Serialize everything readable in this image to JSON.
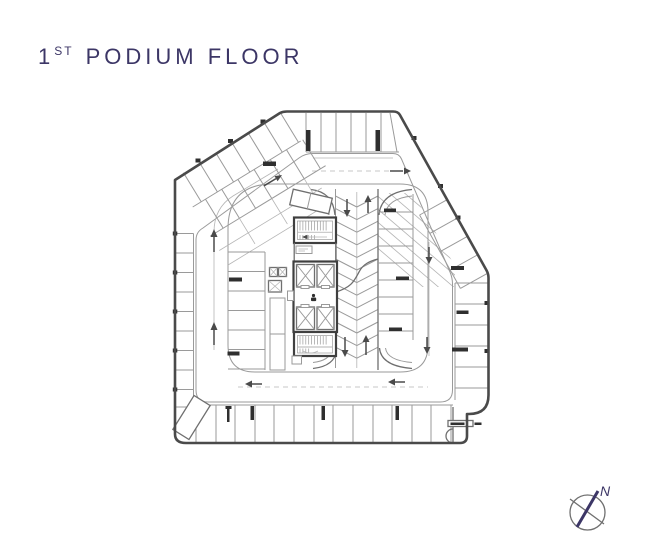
{
  "title": {
    "number": "1",
    "ordinal": "ST",
    "text": "PODIUM FLOOR"
  },
  "compass": {
    "north_label": "N"
  },
  "colors": {
    "title": "#3c3666",
    "outline": "#4a4a4a",
    "line_medium": "#6f6f6f",
    "line_light": "#9a9a9a",
    "line_faint": "#b5b5b5",
    "fill_dark": "#2f2f2f",
    "background": "#ffffff"
  },
  "plan": {
    "type": "parking floor plan",
    "elevator_cells": 4,
    "stairwells": 2,
    "direction_arrows": 12,
    "features": [
      "perimeter parking stalls",
      "angled parking stalls along chamfered corners",
      "central ramp with chevron markings",
      "elevator core with lobby",
      "one-way drive aisle loop",
      "north compass rose"
    ]
  }
}
